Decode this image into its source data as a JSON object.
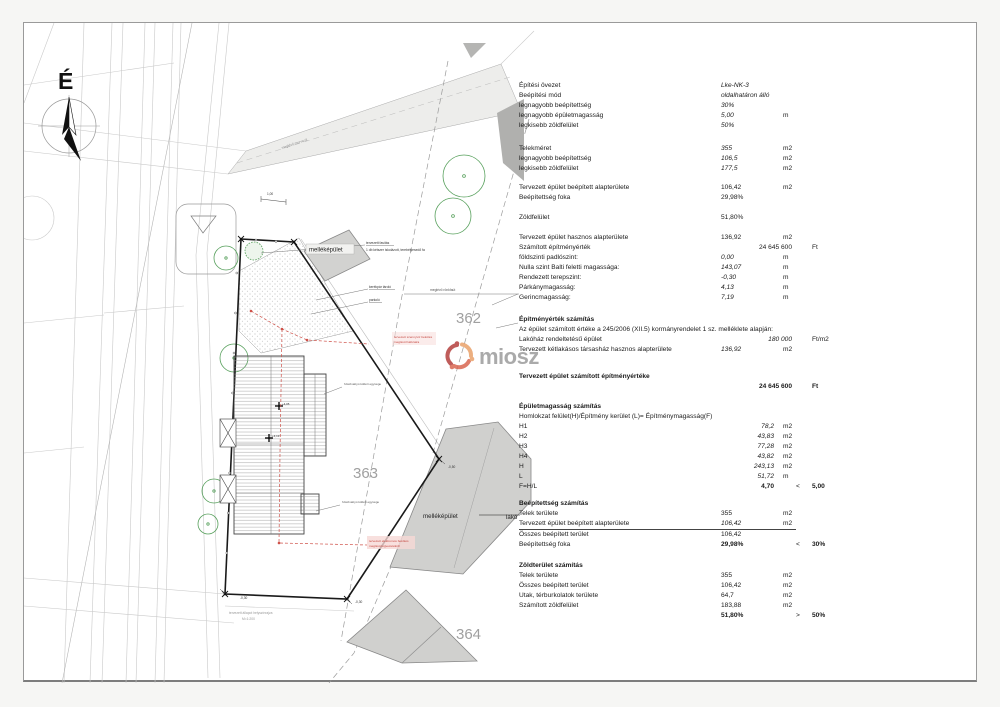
{
  "plan": {
    "labels": {
      "north": "É",
      "outbuilding_top": "melléképület",
      "outbuilding_bottom": "melléképület",
      "lako": "lakó",
      "parcel_362": "362",
      "parcel_363": "363",
      "parcel_364": "364",
      "tree_note_1": "tervezett fasítás",
      "tree_note_2": "1 db kétszer iskolázott, terebélyesedő fa",
      "bike": "kerékpár tároló",
      "parking": "parkoló",
      "road_existing": "meglévő rönkfaút",
      "gravel_road": "meglévő murva út",
      "heatpump_1": "hőszivattyú kültéri egysége",
      "heatpump_2": "hőszivattyú kültéri egysége",
      "sewer_1": "tervezett szennyvíz bekötés",
      "sewer_2": "meglévő hálózatra",
      "elec_1": "tervezett elektromos bekötés",
      "elec_2": "meglévő légvezetékről",
      "level_bl": "-0,30",
      "level_br": "-0,30",
      "level_tr": "-0,50",
      "spot_1": "+4,05",
      "spot_2": "+4,13",
      "dim_1": "1,00",
      "sheet_note_1": "tervezett állapot helyszínrajza",
      "sheet_note_2": "M=1:200",
      "watermark": "miosz"
    },
    "colors": {
      "boundary": "#1a1a1a",
      "neighbor_building": "#d0d0ce",
      "tree_green": "#57a05c",
      "utility_red": "#cf5149",
      "parcel_gray": "#a0a0a0"
    }
  },
  "table": {
    "sections": [
      {
        "gap": 0,
        "rows": [
          {
            "label": "Építési övezet",
            "value": "Lke-NK-3",
            "cls": "iv"
          },
          {
            "label": "Beépítési mód",
            "value": "oldalhatáron álló",
            "cls": "iv"
          },
          {
            "label": "legnagyobb beépítettség",
            "value": "30%",
            "cls": "iv"
          },
          {
            "label": "legnagyobb épületmagasság",
            "value": "5,00",
            "unit": "m",
            "cls": "iv"
          },
          {
            "label": "legkisebb zöldfelület",
            "value": "50%",
            "cls": "iv"
          }
        ]
      },
      {
        "gap": 13,
        "rows": [
          {
            "label": "Telekméret",
            "value": "355",
            "unit": "m2",
            "cls": "iv"
          },
          {
            "label": "legnagyobb beépítettség",
            "value": "106,5",
            "unit": "m2",
            "cls": "iv"
          },
          {
            "label": "legkisebb zöldfelület",
            "value": "177,5",
            "unit": "m2",
            "cls": "iv"
          }
        ]
      },
      {
        "gap": 9,
        "rows": [
          {
            "label": "Tervezett épület beépített alapterülete",
            "value": "106,42",
            "unit": "m2"
          },
          {
            "label": "Beépítettség foka",
            "value": "29,98%"
          }
        ]
      },
      {
        "gap": 10,
        "rows": [
          {
            "label": "Zöldfelület",
            "value": "51,80%"
          }
        ]
      },
      {
        "gap": 10,
        "rows": [
          {
            "label": "Tervezett épület hasznos alapterülete",
            "value": "136,92",
            "unit": "m2"
          },
          {
            "label": "Számított építményérték",
            "value": "24 645 600",
            "unit": "Ft",
            "cls": "shift"
          },
          {
            "label": "földszinti padlószint:",
            "value": "0,00",
            "unit": "m",
            "cls": "iv"
          },
          {
            "label": "Nulla szint Balti feletti magassága:",
            "value": "143,07",
            "unit": "m",
            "cls": "iv"
          },
          {
            "label": "Rendezett terepszint:",
            "value": "-0,30",
            "unit": "m",
            "cls": "iv"
          },
          {
            "label": "Párkánymagasság:",
            "value": "4,13",
            "unit": "m",
            "cls": "iv"
          },
          {
            "label": "Gerincmagasság:",
            "value": "7,19",
            "unit": "m",
            "cls": "iv"
          }
        ]
      },
      {
        "gap": 12,
        "rows": [
          {
            "label": "Építményérték számítás",
            "cls": "title wide"
          },
          {
            "label": "Az épület számított értéke a 245/2006 (XII.5) kormányrendelet 1 sz. melléklete alapján:",
            "cls": "wide"
          },
          {
            "label": "Lakóház rendeltetésű épület",
            "value": "180 000",
            "unit": "Ft/m2",
            "cls": "shift iv"
          },
          {
            "label": "Tervezett kétlakásos társasház hasznos alapterülete",
            "value": "136,92",
            "unit": "m2",
            "cls": "iv"
          }
        ]
      },
      {
        "gap": 17,
        "rows": [
          {
            "label": "Tervezett épület számított építményértéke",
            "value": "24 645 600",
            "unit": "Ft",
            "cls": "shift title"
          }
        ]
      },
      {
        "gap": 10,
        "rows": [
          {
            "label": "Épületmagasság számítás",
            "cls": "title wide"
          },
          {
            "label": "Homlokzat felület(H)/Építmény kerület (L)= Építménymagasság(F)",
            "cls": "wide"
          },
          {
            "label": "H1",
            "value": "78,2",
            "unit": "m2",
            "cls": "iv vr"
          },
          {
            "label": "H2",
            "value": "43,83",
            "unit": "m2",
            "cls": "iv vr"
          },
          {
            "label": "H3",
            "value": "77,28",
            "unit": "m2",
            "cls": "iv vr"
          },
          {
            "label": "H4",
            "value": "43,82",
            "unit": "m2",
            "cls": "iv vr"
          },
          {
            "label": "H",
            "value": "243,13",
            "unit": "m2",
            "cls": "iv vr"
          },
          {
            "label": "L",
            "value": "51,72",
            "unit": "m",
            "cls": "iv vr"
          },
          {
            "label": "F=H/L",
            "value": "4,70",
            "comp": "<",
            "limit": "5,00",
            "cls": "vr bv bx"
          }
        ]
      },
      {
        "gap": 7,
        "rows": [
          {
            "label": "Beépítettség számítás",
            "cls": "title wide"
          },
          {
            "label": "Telek területe",
            "value": "355",
            "unit": "m2"
          },
          {
            "label": "Tervezett épület beépített alapterülete",
            "value": "106,42",
            "unit": "m2",
            "cls": "iv ul"
          },
          {
            "label": "Összes beépített terület",
            "value": "106,42"
          },
          {
            "label": "Beépítettség foka",
            "value": "29,98%",
            "comp": "<",
            "limit": "30%",
            "cls": "bv bx"
          }
        ]
      },
      {
        "gap": 11,
        "rows": [
          {
            "label": "Zöldterület számítás",
            "cls": "title wide"
          },
          {
            "label": "Telek területe",
            "value": "355",
            "unit": "m2"
          },
          {
            "label": "Összes beépített terület",
            "value": "106,42",
            "unit": "m2"
          },
          {
            "label": "Utak, térburkolatok területe",
            "value": "64,7",
            "unit": "m2"
          },
          {
            "label": "Számított zöldfelület",
            "value": "183,88",
            "unit": "m2"
          },
          {
            "label": "",
            "value": "51,80%",
            "comp": ">",
            "limit": "50%",
            "cls": "bv bx"
          }
        ]
      }
    ]
  }
}
